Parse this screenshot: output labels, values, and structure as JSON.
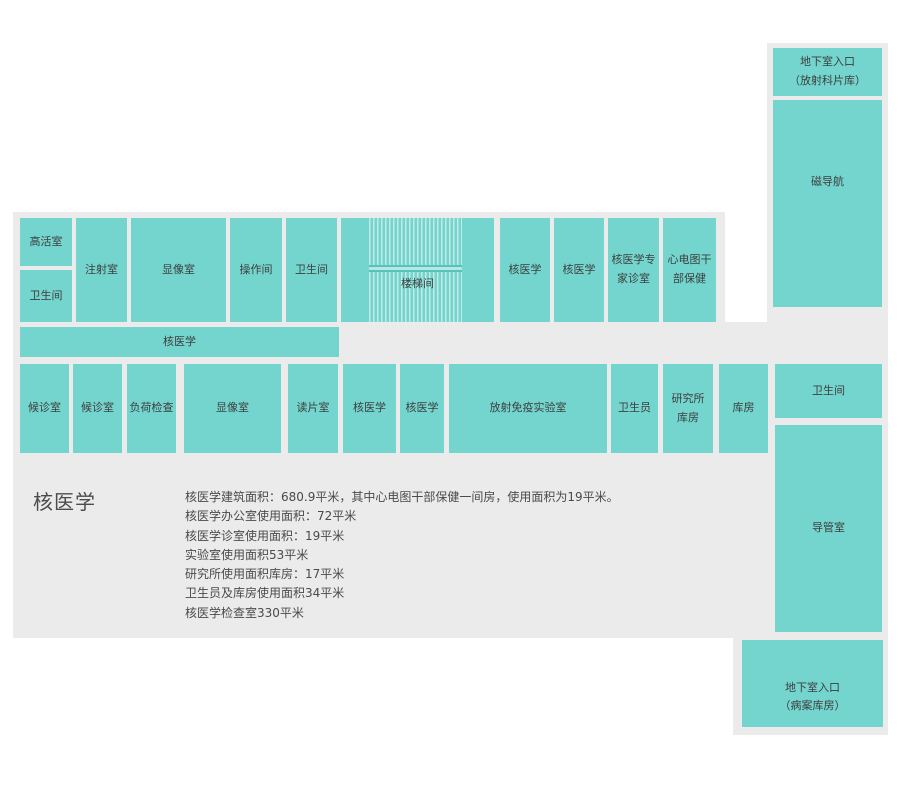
{
  "palette": {
    "room_fill": "#73d5ce",
    "area_background": "#ebebeb",
    "page_background": "#ffffff",
    "stair_stripe": "#c2ebe7",
    "stair_landing_fill": "#b3e8e3",
    "stair_landing_edge": "#58c2ba",
    "room_label_text": "#3e3e3e",
    "summary_text": "#4a4a4a"
  },
  "rooms": [
    {
      "label": "高活室"
    },
    {
      "label": "卫生间"
    },
    {
      "label": "注射室"
    },
    {
      "label": "显像室"
    },
    {
      "label": "操作间"
    },
    {
      "label": "卫生间"
    },
    {
      "label": "楼梯间"
    },
    {
      "label": "核医学"
    },
    {
      "label": "核医学"
    },
    {
      "label": "核医学专\n家诊室"
    },
    {
      "label": "心电图干\n部保健"
    },
    {
      "label": "核医学"
    },
    {
      "label": "候诊室"
    },
    {
      "label": "候诊室"
    },
    {
      "label": "负荷检查"
    },
    {
      "label": "显像室"
    },
    {
      "label": "读片室"
    },
    {
      "label": "核医学"
    },
    {
      "label": "核医学"
    },
    {
      "label": "放射免疫实验室"
    },
    {
      "label": "卫生员"
    },
    {
      "label": "研究所\n库房"
    },
    {
      "label": "库房"
    },
    {
      "label": "地下室入口\n（放射科片库）"
    },
    {
      "label": "磁导航"
    },
    {
      "label": "卫生间"
    },
    {
      "label": "导管室"
    },
    {
      "label": "地下室入口\n（病案库房）"
    }
  ],
  "summary": {
    "title": "核医学",
    "lines": [
      "核医学建筑面积：680.9平米，其中心电图干部保健一间房，使用面积为19平米。",
      "核医学办公室使用面积：72平米",
      "核医学诊室使用面积：19平米",
      "实验室使用面积53平米",
      "研究所使用面积库房：17平米",
      "卫生员及库房使用面积34平米",
      "核医学检查室330平米"
    ]
  }
}
